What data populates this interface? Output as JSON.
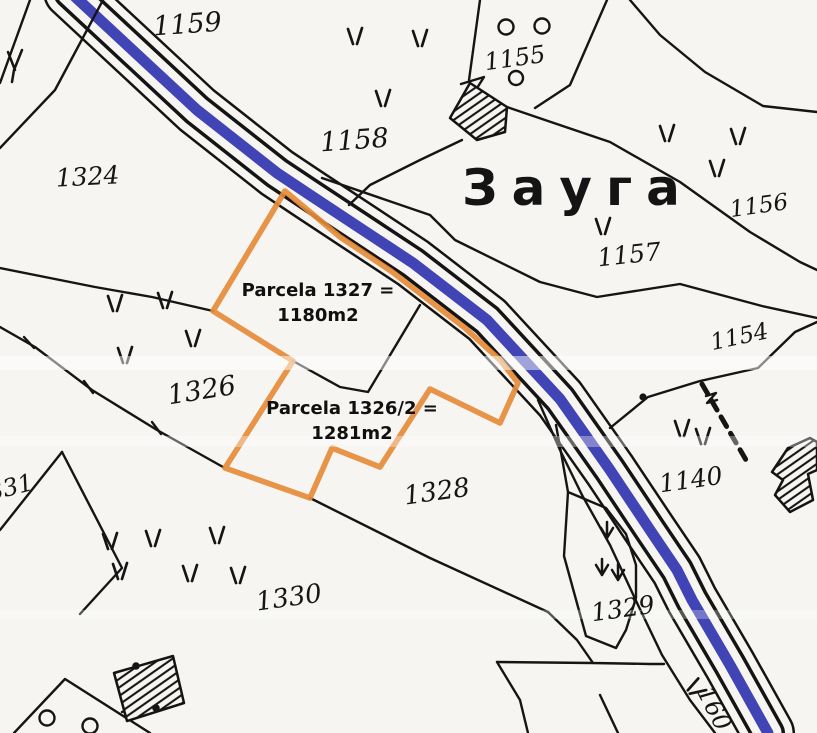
{
  "map": {
    "region_label": "Зауга",
    "parcels": [
      {
        "label": "1159"
      },
      {
        "label": "1158"
      },
      {
        "label": "1155"
      },
      {
        "label": "1156"
      },
      {
        "label": "1157"
      },
      {
        "label": "1324"
      },
      {
        "label": "1154"
      },
      {
        "label": "1326"
      },
      {
        "label": "1140"
      },
      {
        "label": "1328"
      },
      {
        "label": "1330"
      },
      {
        "label": "1329"
      },
      {
        "label": "1331"
      },
      {
        "label": "160"
      }
    ],
    "annotations": [
      {
        "line1": "Parcela 1327 =",
        "line2": "1180m2"
      },
      {
        "line1": "Parcela 1326/2 =",
        "line2": "1281m2"
      }
    ],
    "colors": {
      "highlight": "#E58B3A",
      "water": "#4044B4",
      "ink": "#161616",
      "paper": "#F6F5F1"
    }
  }
}
